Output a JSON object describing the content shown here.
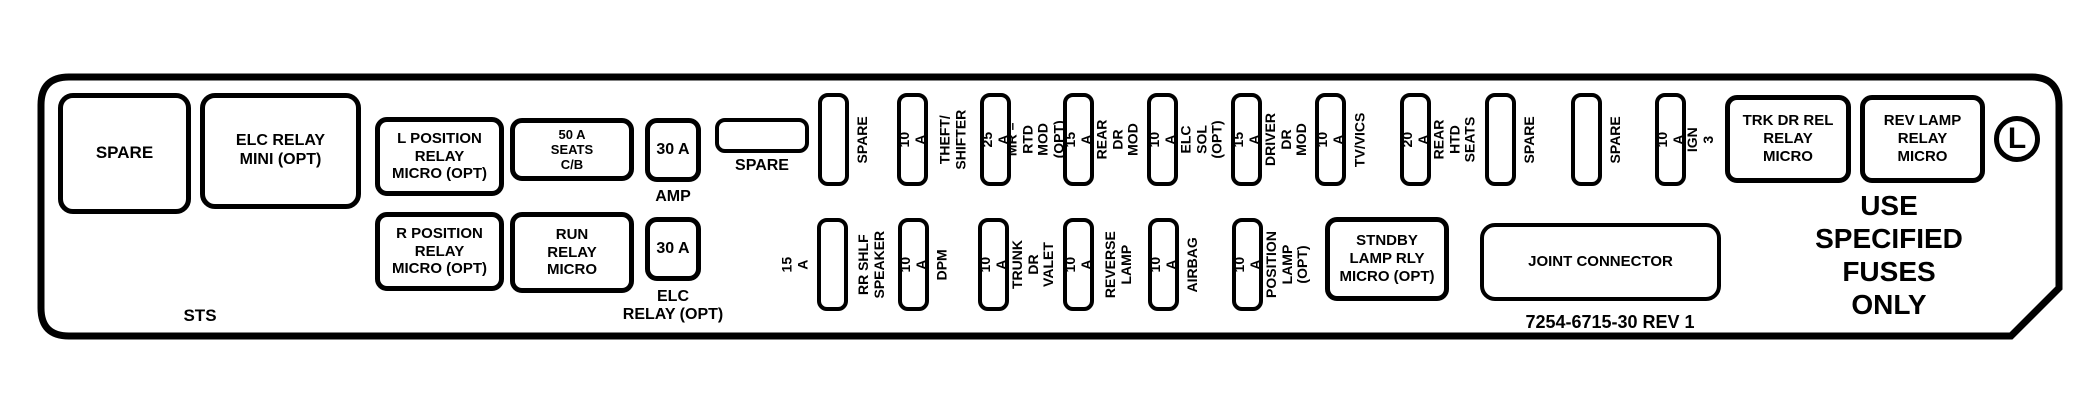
{
  "panel": {
    "model_label": "STS",
    "part_number": "7254-6715-30 REV 1",
    "warning": "USE\nSPECIFIED\nFUSES\nONLY",
    "marker_letter": "L"
  },
  "relays": {
    "spare_large": "SPARE",
    "elc_relay_mini": "ELC RELAY\nMINI (OPT)",
    "l_position": "L POSITION\nRELAY\nMICRO (OPT)",
    "r_position": "R POSITION\nRELAY\nMICRO (OPT)",
    "seats_breaker": "50 A\nSEATS\nC/B",
    "run_relay": "RUN\nRELAY\nMICRO",
    "trk_dr_rel": "TRK DR REL\nRELAY\nMICRO",
    "rev_lamp": "REV LAMP\nRELAY\nMICRO",
    "stndby_lamp": "STNDBY\nLAMP RLY\nMICRO (OPT)",
    "joint_connector": "JOINT CONNECTOR"
  },
  "amp_fuses": {
    "amp_value": "30 A",
    "amp_label": "AMP",
    "elc_value": "30 A",
    "elc_label": "ELC\nRELAY (OPT)",
    "spare_h_label": "SPARE"
  },
  "top_fuses": [
    {
      "amp": "",
      "label": "SPARE"
    },
    {
      "amp": "10 A",
      "label": "THEFT/\nSHIFTER"
    },
    {
      "amp": "25 A",
      "label": "MR – RTD\nMOD (OPT)"
    },
    {
      "amp": "15 A",
      "label": "REAR DR\nMOD"
    },
    {
      "amp": "10 A",
      "label": "ELC SOL\n(OPT)"
    },
    {
      "amp": "15 A",
      "label": "DRIVER DR\nMOD"
    },
    {
      "amp": "10 A",
      "label": "TV/VICS"
    },
    {
      "amp": "20 A",
      "label": "REAR HTD\nSEATS"
    },
    {
      "amp": "",
      "label": "SPARE"
    },
    {
      "amp": "",
      "label": "SPARE"
    },
    {
      "amp": "10 A",
      "label": "IGN 3"
    }
  ],
  "bottom_fuses": [
    {
      "amp": "",
      "amp_outside": "15 A",
      "label": "RR SHLF\nSPEAKER"
    },
    {
      "amp": "10 A",
      "label": "DPM"
    },
    {
      "amp": "10 A",
      "label": "TRUNK DR\nVALET"
    },
    {
      "amp": "10 A",
      "label": "REVERSE\nLAMP"
    },
    {
      "amp": "10 A",
      "label": "AIRBAG"
    },
    {
      "amp": "10 A",
      "label": "POSITION\nLAMP (OPT)"
    }
  ]
}
